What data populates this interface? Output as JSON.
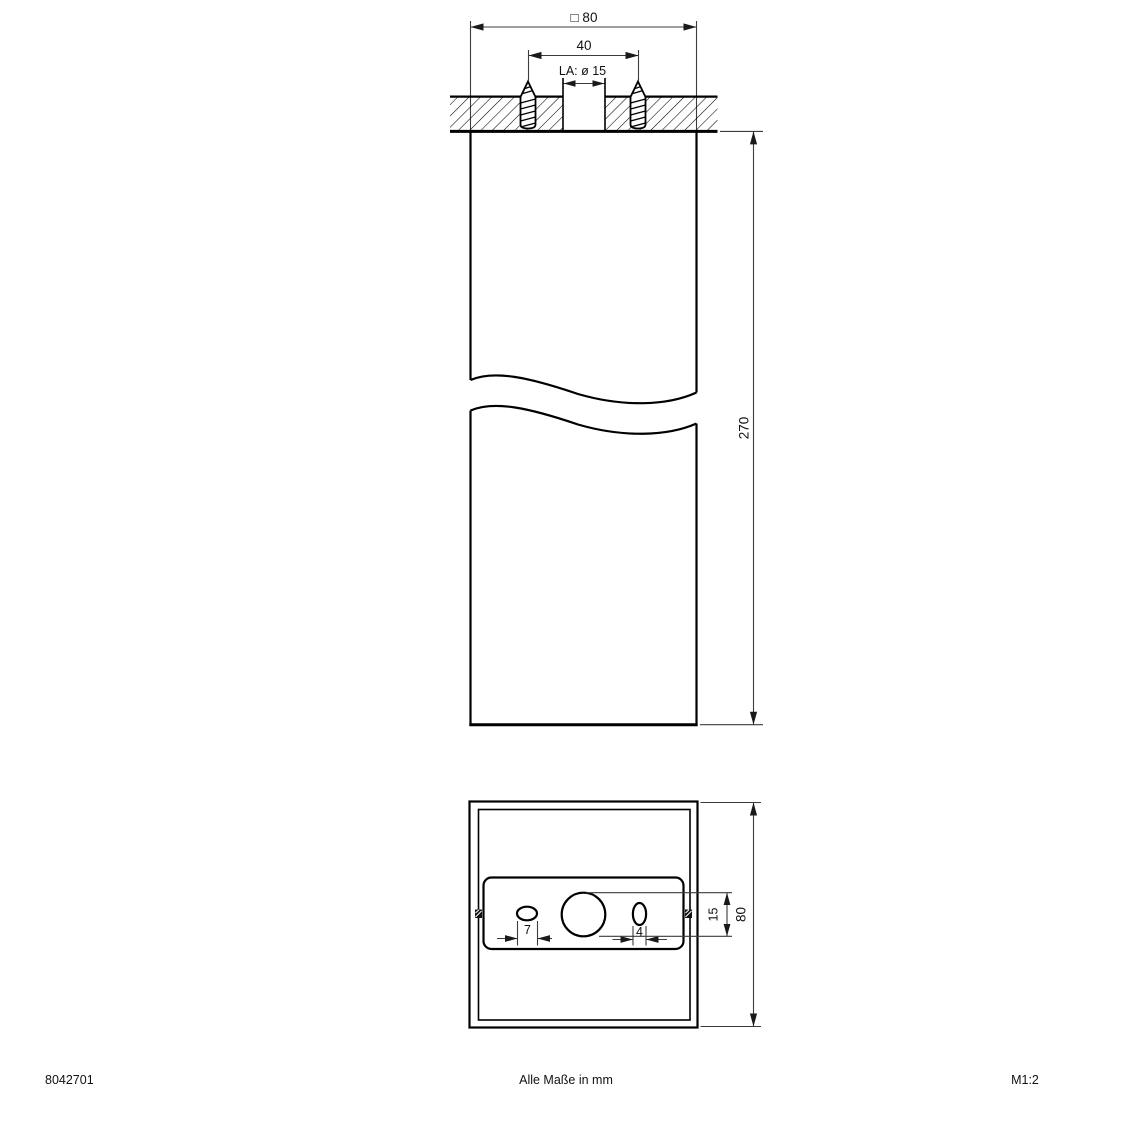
{
  "page": {
    "background": "#ffffff",
    "line_color": "#000000",
    "dim_line_color": "#3c3c3c"
  },
  "top_view": {
    "dim_outer_width_label": "□ 80",
    "dim_screw_spacing_label": "40",
    "cable_outlet_label": "LA: ø 15",
    "dim_height_label": "270"
  },
  "bottom_view": {
    "dim_cutout_label": "15",
    "dim_width_label": "80",
    "dim_slot_left_label": "7",
    "dim_slot_right_label": "4"
  },
  "footer": {
    "article_number": "8042701",
    "units_note": "Alle Maße in mm",
    "scale": "M1:2"
  }
}
